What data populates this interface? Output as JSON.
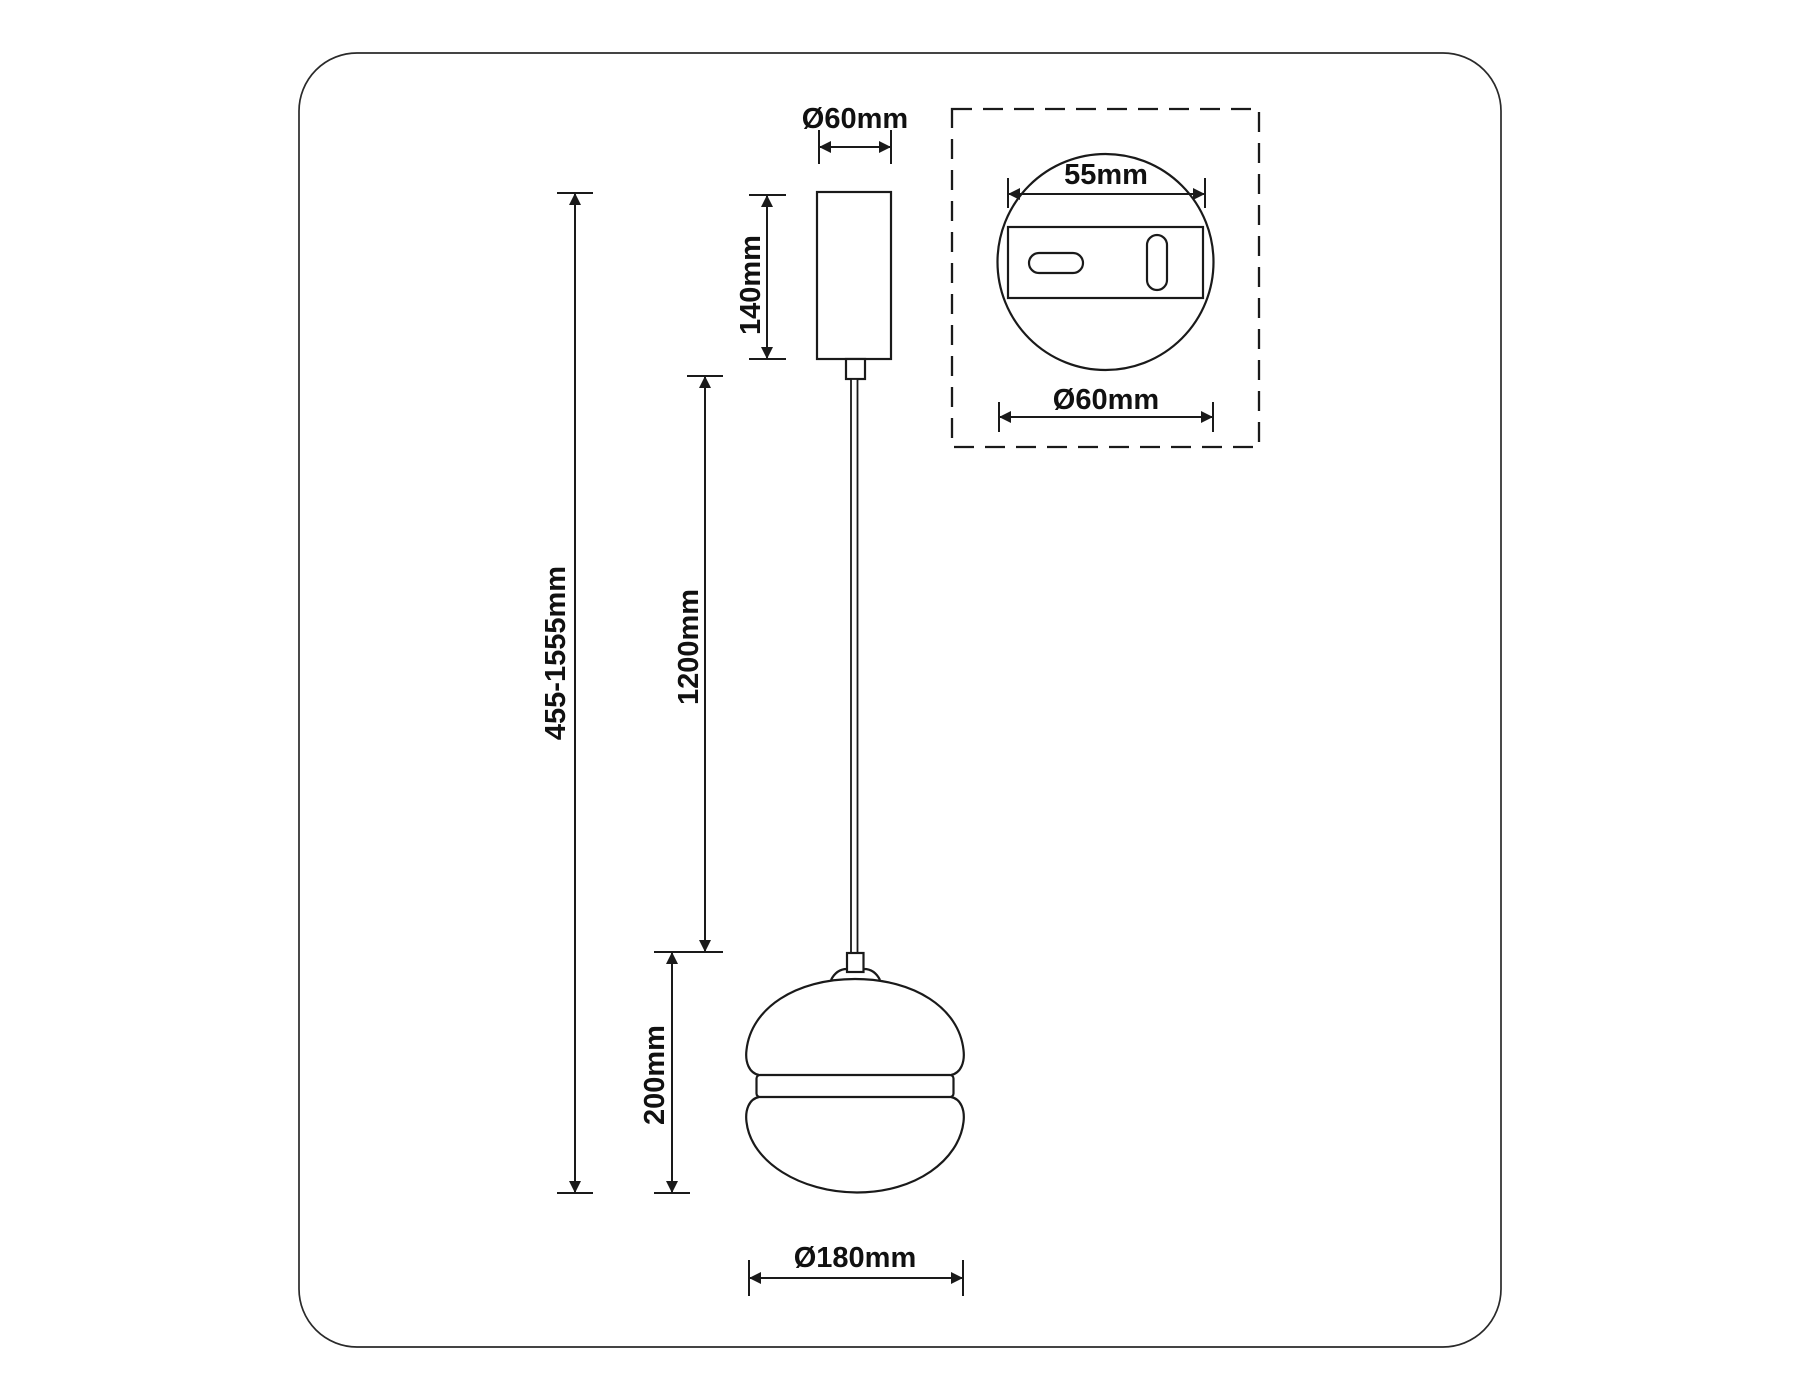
{
  "drawing": {
    "title_hint": "pendant-lamp-dimension-drawing",
    "background": "#ffffff",
    "line_color": "#1a1a1a"
  },
  "labels": {
    "canopy_diameter": "Ø60mm",
    "canopy_height": "140mm",
    "cable_length": "1200mm",
    "overall_height": "455-1555mm",
    "shade_height": "200mm",
    "shade_diameter": "Ø180mm",
    "mount_hole_spacing": "55mm",
    "mount_plate_diameter": "Ø60mm"
  }
}
